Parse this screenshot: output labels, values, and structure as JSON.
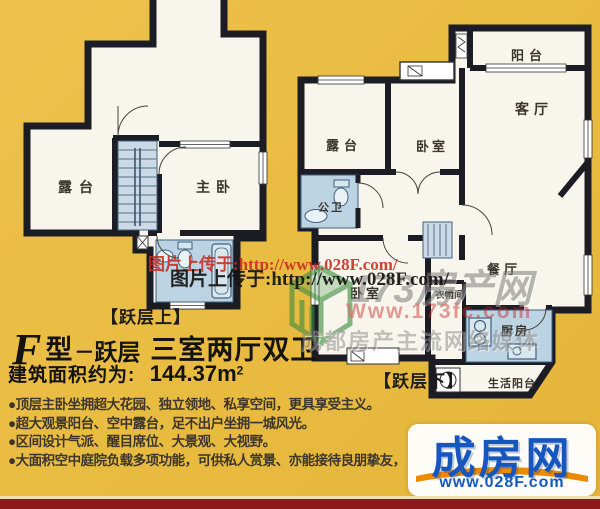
{
  "colors": {
    "background": "#E9BC42",
    "wall": "#1C1C24",
    "room_fill": "#F7F5EC",
    "wet_room_fill": "#BBD3E2",
    "stair_fill": "#CBDAE6",
    "watermark_red": "#C72A20",
    "logo_blue": "#1756BD",
    "logo_orange": "#EE8A00",
    "bottom_band_red": "#8C191D"
  },
  "captions": {
    "upper_plan": "【跃层上】",
    "lower_plan": "【跃层下】"
  },
  "title": {
    "type_letter": "F",
    "type_word": "型",
    "dash": "－",
    "level_word": "跃层",
    "layout": "三室两厅双卫",
    "area_label": "建筑面积约为:",
    "area_value": "144.37m",
    "area_exponent": "2"
  },
  "features": [
    "●顶层主卧坐拥超大花园、独立领地、私享空间，更具享受主义。",
    "●超大观景阳台、空中露台，足不出户坐拥一城风光。",
    "●区间设计气派、醒目席位、大景观、大视野。",
    "●大面积空中庭院负载多项功能，可供私人赏景、亦能接待良朋挚友，"
  ],
  "rooms": {
    "upper": {
      "terrace": "露台",
      "master_bedroom": "主卧"
    },
    "lower": {
      "balcony": "阳台",
      "living_room": "客厅",
      "terrace": "露台",
      "bedroom_upper": "卧室",
      "bathroom": "公卫",
      "dining_room": "餐厅",
      "bedroom_lower": "卧室",
      "cloakroom": "衣帽间",
      "kitchen": "厨房",
      "service_balcony": "生活阳台"
    }
  },
  "watermarks": {
    "upload_note_red": "图片上传于:http://www.028F.com/",
    "upload_note_black": "图片上传于:http://www.028F.com/",
    "site_name": "173房产网",
    "site_url": "Www.173fc.com",
    "site_slogan": "成都房产主流网络媒体"
  },
  "logo": {
    "brand": "成房网",
    "url": "www.028F.com"
  }
}
